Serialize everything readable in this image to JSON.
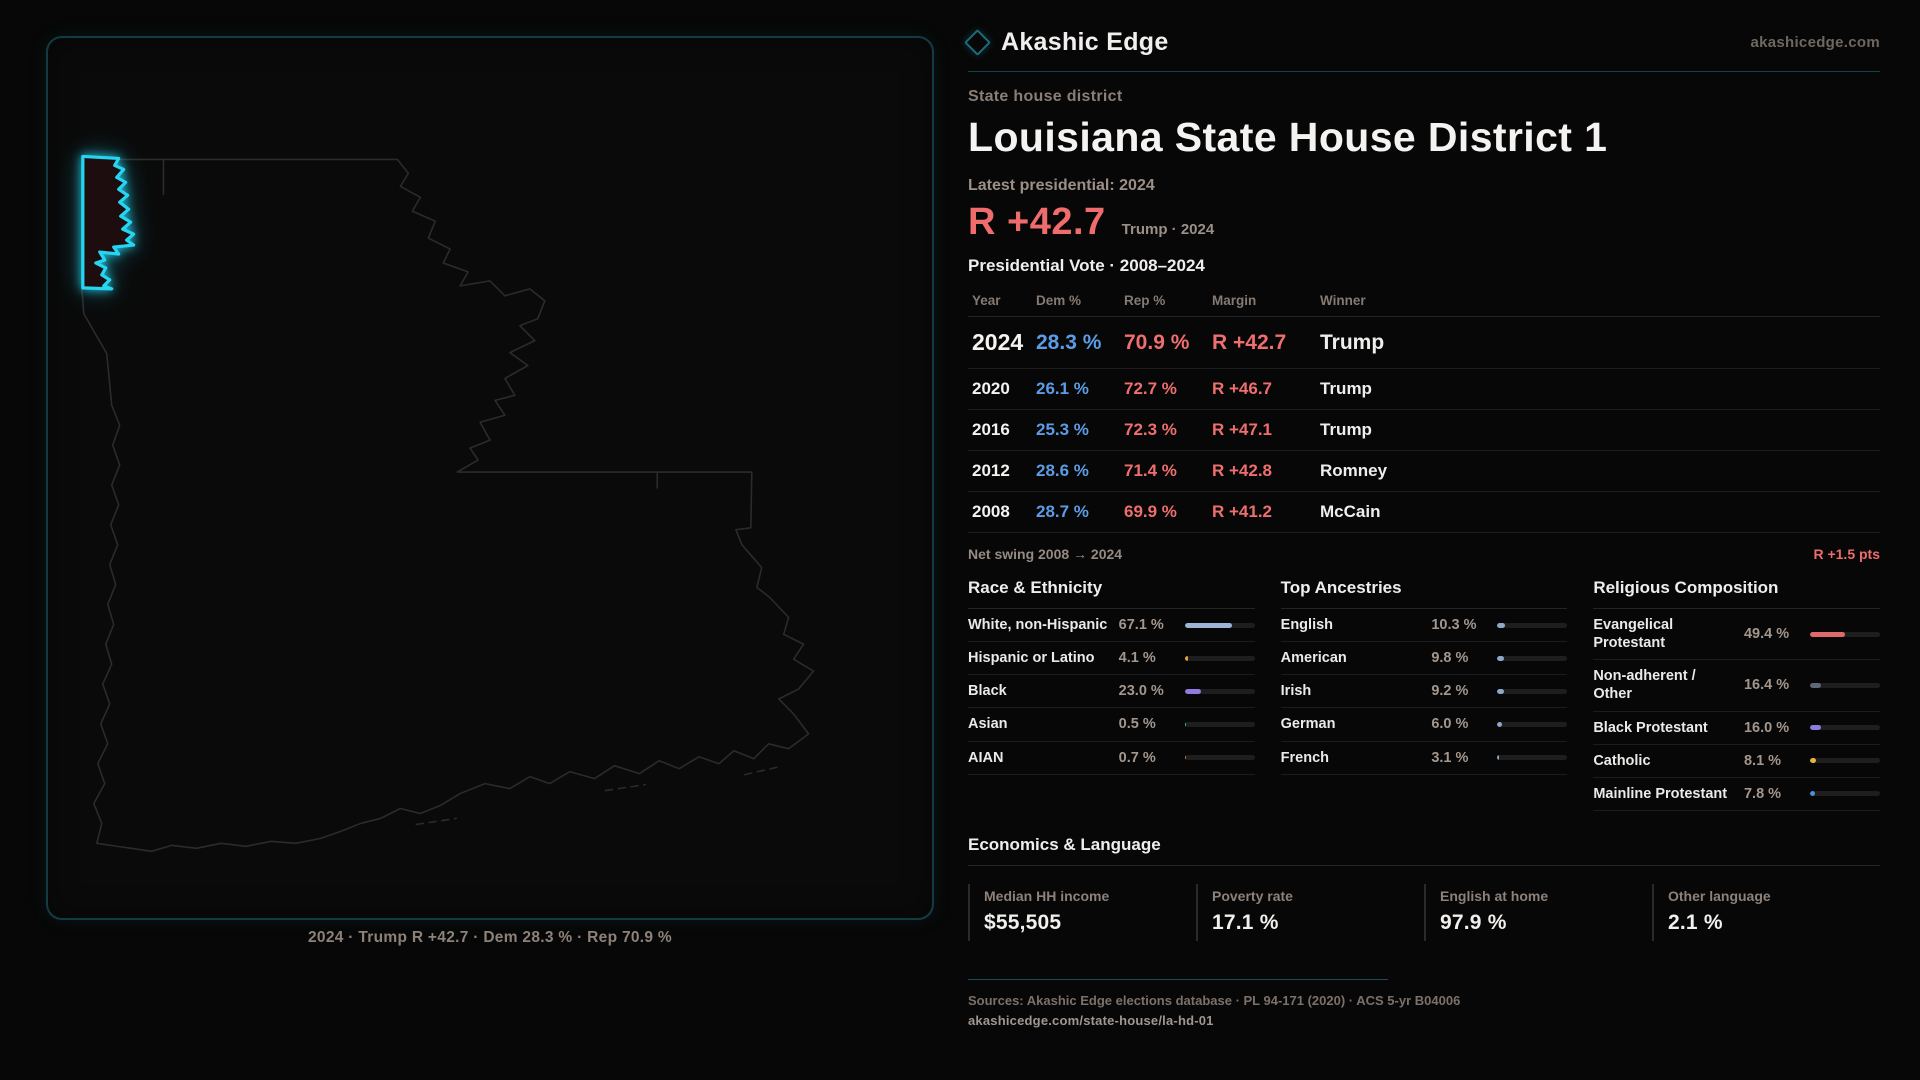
{
  "brand": {
    "name": "Akashic Edge",
    "site": "akashicedge.com"
  },
  "header": {
    "kicker": "State house district",
    "title": "Louisiana State House District 1",
    "latest_label": "Latest presidential: 2024",
    "margin_big": "R +42.7",
    "margin_context": "Trump · 2024"
  },
  "table": {
    "title": "Presidential Vote · 2008–2024",
    "columns": {
      "year": "Year",
      "dem": "Dem %",
      "rep": "Rep %",
      "margin": "Margin",
      "winner": "Winner"
    },
    "rows": [
      {
        "year": "2024",
        "dem": "28.3 %",
        "rep": "70.9 %",
        "margin": "R +42.7",
        "winner": "Trump"
      },
      {
        "year": "2020",
        "dem": "26.1 %",
        "rep": "72.7 %",
        "margin": "R +46.7",
        "winner": "Trump"
      },
      {
        "year": "2016",
        "dem": "25.3 %",
        "rep": "72.3 %",
        "margin": "R +47.1",
        "winner": "Trump"
      },
      {
        "year": "2012",
        "dem": "28.6 %",
        "rep": "71.4 %",
        "margin": "R +42.8",
        "winner": "Romney"
      },
      {
        "year": "2008",
        "dem": "28.7 %",
        "rep": "69.9 %",
        "margin": "R +41.2",
        "winner": "McCain"
      }
    ]
  },
  "net_swing": {
    "label": "Net swing 2008 → 2024",
    "value": "R +1.5 pts"
  },
  "race": {
    "title": "Race & Ethnicity",
    "rows": [
      {
        "label": "White, non-Hispanic",
        "value": "67.1 %",
        "pct": 67.1,
        "color": "#9db4d6"
      },
      {
        "label": "Hispanic or Latino",
        "value": "4.1 %",
        "pct": 4.1,
        "color": "#e8a13c"
      },
      {
        "label": "Black",
        "value": "23.0 %",
        "pct": 23.0,
        "color": "#8f7ae0"
      },
      {
        "label": "Asian",
        "value": "0.5 %",
        "pct": 0.5,
        "color": "#3fb8c9"
      },
      {
        "label": "AIAN",
        "value": "0.7 %",
        "pct": 0.7,
        "color": "#c9803f"
      }
    ]
  },
  "ancestries": {
    "title": "Top Ancestries",
    "rows": [
      {
        "label": "English",
        "value": "10.3 %",
        "pct": 10.3,
        "color": "#8da8c9"
      },
      {
        "label": "American",
        "value": "9.8 %",
        "pct": 9.8,
        "color": "#8da8c9"
      },
      {
        "label": "Irish",
        "value": "9.2 %",
        "pct": 9.2,
        "color": "#8da8c9"
      },
      {
        "label": "German",
        "value": "6.0 %",
        "pct": 6.0,
        "color": "#8da8c9"
      },
      {
        "label": "French",
        "value": "3.1 %",
        "pct": 3.1,
        "color": "#8da8c9"
      }
    ]
  },
  "religion": {
    "title": "Religious Composition",
    "rows": [
      {
        "label": "Evangelical Protestant",
        "value": "49.4 %",
        "pct": 49.4,
        "color": "#e06a6a"
      },
      {
        "label": "Non-adherent / Other",
        "value": "16.4 %",
        "pct": 16.4,
        "color": "#5d6775"
      },
      {
        "label": "Black Protestant",
        "value": "16.0 %",
        "pct": 16.0,
        "color": "#8f7ae0"
      },
      {
        "label": "Catholic",
        "value": "8.1 %",
        "pct": 8.1,
        "color": "#e5b43a"
      },
      {
        "label": "Mainline Protestant",
        "value": "7.8 %",
        "pct": 7.8,
        "color": "#4a90e2"
      }
    ]
  },
  "economics": {
    "title": "Economics & Language",
    "stats": [
      {
        "label": "Median HH income",
        "value": "$55,505"
      },
      {
        "label": "Poverty rate",
        "value": "17.1 %"
      },
      {
        "label": "English at home",
        "value": "97.9 %"
      },
      {
        "label": "Other language",
        "value": "2.1 %"
      }
    ]
  },
  "footer": {
    "sources": "Sources: Akashic Edge elections database · PL 94-171 (2020) · ACS 5-yr B04006",
    "permalink": "akashicedge.com/state-house/la-hd-01"
  },
  "map": {
    "caption": "2024 · Trump R +42.7 · Dem 28.3 % · Rep 70.9 %"
  },
  "colors": {
    "accent_cyan": "#25d5f2",
    "dem_blue": "#5c9ce6",
    "rep_red": "#ef6e6e",
    "panel_teal": "#143b44"
  }
}
